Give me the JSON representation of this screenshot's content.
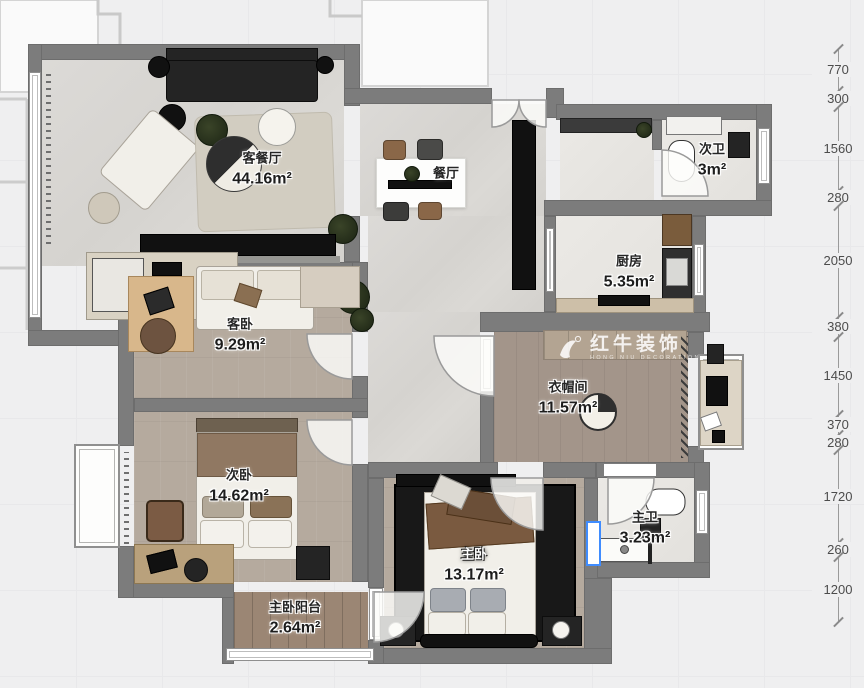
{
  "watermark": {
    "brand": "红牛装饰",
    "brand_sub": "HONG NIU DECORATION"
  },
  "rooms": [
    {
      "name": "客餐厅",
      "area": "44.16m²"
    },
    {
      "name": "餐厅",
      "area": ""
    },
    {
      "name": "次卫",
      "area": "3m²"
    },
    {
      "name": "厨房",
      "area": "5.35m²"
    },
    {
      "name": "客卧",
      "area": "9.29m²"
    },
    {
      "name": "衣帽间",
      "area": "11.57m²"
    },
    {
      "name": "次卧",
      "area": "14.62m²"
    },
    {
      "name": "主卧",
      "area": "13.17m²"
    },
    {
      "name": "主卫",
      "area": "3.23m²"
    },
    {
      "name": "主卧阳台",
      "area": "2.64m²"
    }
  ],
  "dimensions": {
    "unit": "mm",
    "values": [
      770,
      300,
      1560,
      280,
      2050,
      380,
      1450,
      370,
      280,
      1720,
      260,
      1200
    ]
  },
  "colors": {
    "wall": "#7c7c7c",
    "selection": "#3f8cff",
    "marble": "#d9d7d3",
    "wood": "#b5aa9e",
    "tile": "#e9e7e3",
    "balcony": "#9b8674",
    "rug": "#181818"
  }
}
